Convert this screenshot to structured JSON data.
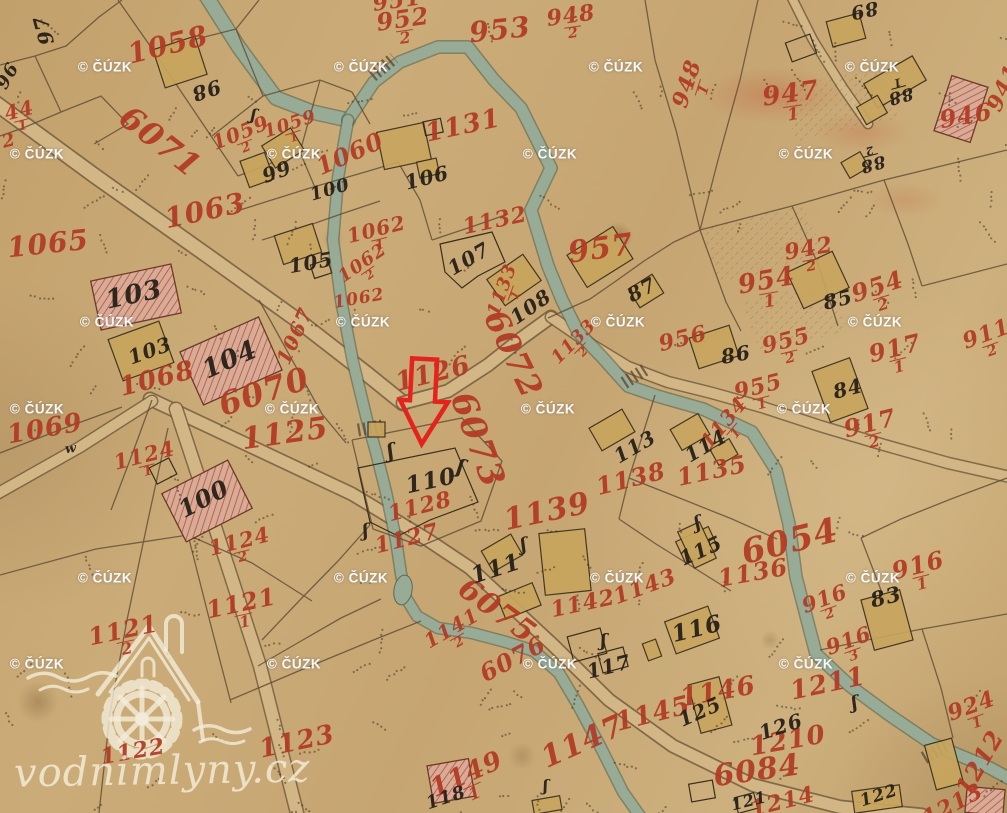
{
  "map_title": "historical cadastral map sheet",
  "watermark": {
    "text": "© ČÚZK",
    "positions": [
      {
        "x": 105,
        "y": 67
      },
      {
        "x": 361,
        "y": 67
      },
      {
        "x": 616,
        "y": 67
      },
      {
        "x": 872,
        "y": 67
      },
      {
        "x": 37,
        "y": 154
      },
      {
        "x": 294,
        "y": 154
      },
      {
        "x": 550,
        "y": 154
      },
      {
        "x": 806,
        "y": 154
      },
      {
        "x": 107,
        "y": 322
      },
      {
        "x": 363,
        "y": 322
      },
      {
        "x": 618,
        "y": 322
      },
      {
        "x": 875,
        "y": 322
      },
      {
        "x": 37,
        "y": 409
      },
      {
        "x": 292,
        "y": 409
      },
      {
        "x": 548,
        "y": 409
      },
      {
        "x": 804,
        "y": 409
      },
      {
        "x": 105,
        "y": 578
      },
      {
        "x": 361,
        "y": 578
      },
      {
        "x": 617,
        "y": 578
      },
      {
        "x": 873,
        "y": 578
      },
      {
        "x": 37,
        "y": 664
      },
      {
        "x": 294,
        "y": 664
      },
      {
        "x": 550,
        "y": 664
      },
      {
        "x": 806,
        "y": 664
      }
    ]
  },
  "logo": {
    "text": "vodnimlyny.cz",
    "icon": "watermill-house-icon"
  },
  "arrow": {
    "color": "#e4231d",
    "shape": "hollow-down-arrow",
    "points_at_parcel": "110"
  },
  "colors": {
    "paper": "#c7a673",
    "stream": "#97ab97",
    "road": "#d3b685",
    "building_wood": "#c8a55e",
    "building_stone": "#d9ab97",
    "ink_red": "#b23a24",
    "ink_black": "#272019",
    "arrow": "#e4231d",
    "watermark": "#ffffff",
    "logo": "#f2ecd8"
  },
  "labels": {
    "red": [
      {
        "t": "951",
        "x": 397,
        "y": 1,
        "r": -8,
        "s": 22
      },
      {
        "t": "1058",
        "x": 168,
        "y": 45,
        "r": -14,
        "s": 28
      },
      {
        "t": "952",
        "d": "2",
        "x": 404,
        "y": 27,
        "r": -8,
        "s": 24
      },
      {
        "t": "953",
        "x": 500,
        "y": 30,
        "r": -6,
        "s": 28
      },
      {
        "t": "948",
        "d": "2",
        "x": 572,
        "y": 23,
        "r": -8,
        "s": 22
      },
      {
        "t": "948",
        "d": "1",
        "x": 694,
        "y": 86,
        "r": -72,
        "s": 22
      },
      {
        "t": "947",
        "d": "1",
        "x": 792,
        "y": 102,
        "r": -8,
        "s": 26
      },
      {
        "t": "946",
        "x": 966,
        "y": 116,
        "r": -10,
        "s": 24
      },
      {
        "t": "941",
        "x": 1004,
        "y": 88,
        "r": -65,
        "s": 22
      },
      {
        "t": "942",
        "d": "2",
        "x": 810,
        "y": 256,
        "r": -10,
        "s": 22
      },
      {
        "t": "6071",
        "x": 160,
        "y": 142,
        "r": 38,
        "s": 32
      },
      {
        "t": "1059",
        "d": "2",
        "x": 243,
        "y": 139,
        "r": -22,
        "s": 20
      },
      {
        "t": "1059",
        "d": "1",
        "x": 292,
        "y": 130,
        "r": -18,
        "s": 18
      },
      {
        "t": "1060",
        "x": 350,
        "y": 154,
        "r": -24,
        "s": 24
      },
      {
        "t": "1131",
        "x": 463,
        "y": 126,
        "r": -12,
        "s": 26
      },
      {
        "t": "1063",
        "x": 205,
        "y": 211,
        "r": -12,
        "s": 28
      },
      {
        "t": "1065",
        "x": 48,
        "y": 244,
        "r": -6,
        "s": 28
      },
      {
        "t": "1062",
        "d": "1",
        "x": 378,
        "y": 236,
        "r": -14,
        "s": 20
      },
      {
        "t": "1062",
        "d": "2",
        "x": 366,
        "y": 268,
        "r": -35,
        "s": 18
      },
      {
        "t": "1062",
        "x": 359,
        "y": 299,
        "r": -10,
        "s": 17
      },
      {
        "t": "1132",
        "x": 495,
        "y": 221,
        "r": -12,
        "s": 22
      },
      {
        "t": "957",
        "x": 601,
        "y": 249,
        "r": -8,
        "s": 30
      },
      {
        "t": "1067",
        "x": 295,
        "y": 336,
        "r": -66,
        "s": 20
      },
      {
        "t": "1068",
        "x": 157,
        "y": 379,
        "r": -14,
        "s": 26
      },
      {
        "t": "6070",
        "x": 264,
        "y": 392,
        "r": -18,
        "s": 32
      },
      {
        "t": "1069",
        "x": 45,
        "y": 429,
        "r": -10,
        "s": 26
      },
      {
        "t": "1125",
        "x": 285,
        "y": 434,
        "r": -8,
        "s": 30
      },
      {
        "t": "1124",
        "d": "1",
        "x": 146,
        "y": 462,
        "r": -14,
        "s": 21
      },
      {
        "t": "1124",
        "d": "2",
        "x": 241,
        "y": 548,
        "r": -14,
        "s": 21
      },
      {
        "t": "1126",
        "x": 433,
        "y": 374,
        "r": -14,
        "s": 26
      },
      {
        "t": "6072",
        "x": 513,
        "y": 354,
        "r": 64,
        "s": 32
      },
      {
        "t": "1133",
        "d": "1",
        "x": 508,
        "y": 292,
        "r": -70,
        "s": 18
      },
      {
        "t": "1133",
        "d": "2",
        "x": 578,
        "y": 346,
        "r": -45,
        "s": 18
      },
      {
        "t": "6073",
        "x": 477,
        "y": 440,
        "r": 70,
        "s": 34
      },
      {
        "t": "1128",
        "x": 420,
        "y": 507,
        "r": -14,
        "s": 22
      },
      {
        "t": "1127",
        "x": 407,
        "y": 539,
        "r": -14,
        "s": 22
      },
      {
        "t": "1139",
        "x": 547,
        "y": 512,
        "r": -12,
        "s": 30
      },
      {
        "t": "1138",
        "x": 631,
        "y": 479,
        "r": -14,
        "s": 24
      },
      {
        "t": "1134",
        "d": "1",
        "x": 729,
        "y": 427,
        "r": -50,
        "s": 20
      },
      {
        "t": "1135",
        "x": 712,
        "y": 471,
        "r": -12,
        "s": 24
      },
      {
        "t": "956",
        "x": 683,
        "y": 339,
        "r": -14,
        "s": 22
      },
      {
        "t": "955",
        "d": "2",
        "x": 788,
        "y": 348,
        "r": -14,
        "s": 22
      },
      {
        "t": "955",
        "d": "1",
        "x": 760,
        "y": 394,
        "r": -14,
        "s": 22
      },
      {
        "t": "954",
        "d": "1",
        "x": 768,
        "y": 289,
        "r": -10,
        "s": 26
      },
      {
        "t": "954",
        "d": "2",
        "x": 880,
        "y": 294,
        "r": -18,
        "s": 24
      },
      {
        "t": "917",
        "d": "1",
        "x": 897,
        "y": 356,
        "r": -14,
        "s": 24
      },
      {
        "t": "911",
        "d": "2",
        "x": 989,
        "y": 341,
        "r": -20,
        "s": 22
      },
      {
        "t": "917",
        "d": "2",
        "x": 872,
        "y": 431,
        "r": -14,
        "s": 24
      },
      {
        "t": "1136",
        "x": 753,
        "y": 573,
        "r": -10,
        "s": 24
      },
      {
        "t": "6054",
        "x": 790,
        "y": 542,
        "r": -14,
        "s": 34
      },
      {
        "t": "1141",
        "d": "2",
        "x": 455,
        "y": 634,
        "r": -30,
        "s": 20
      },
      {
        "t": "1142",
        "x": 583,
        "y": 604,
        "r": -12,
        "s": 22
      },
      {
        "t": "1143",
        "x": 645,
        "y": 587,
        "r": -20,
        "s": 22
      },
      {
        "t": "6075",
        "x": 497,
        "y": 611,
        "r": 36,
        "s": 30
      },
      {
        "t": "6076",
        "x": 513,
        "y": 659,
        "r": -28,
        "s": 24
      },
      {
        "t": "1145",
        "x": 653,
        "y": 714,
        "r": -14,
        "s": 26
      },
      {
        "t": "1146",
        "x": 718,
        "y": 692,
        "r": -10,
        "s": 26
      },
      {
        "t": "1147",
        "x": 583,
        "y": 742,
        "r": -24,
        "s": 30
      },
      {
        "t": "1149",
        "d": "1",
        "x": 470,
        "y": 782,
        "r": -24,
        "s": 26
      },
      {
        "t": "1123",
        "x": 297,
        "y": 742,
        "r": -12,
        "s": 26
      },
      {
        "t": "1121",
        "d": "1",
        "x": 243,
        "y": 611,
        "r": -12,
        "s": 24
      },
      {
        "t": "1121",
        "d": "2",
        "x": 125,
        "y": 638,
        "r": -12,
        "s": 24
      },
      {
        "t": "1122",
        "x": 133,
        "y": 752,
        "r": -10,
        "s": 22
      },
      {
        "t": "916",
        "d": "1",
        "x": 920,
        "y": 573,
        "r": -14,
        "s": 24
      },
      {
        "t": "916",
        "d": "2",
        "x": 827,
        "y": 605,
        "r": -20,
        "s": 21
      },
      {
        "t": "916",
        "d": "3",
        "x": 851,
        "y": 647,
        "r": -20,
        "s": 21
      },
      {
        "t": "924",
        "d": "1",
        "x": 974,
        "y": 713,
        "r": -20,
        "s": 22
      },
      {
        "t": "1210",
        "x": 788,
        "y": 741,
        "r": -10,
        "s": 26
      },
      {
        "t": "1211",
        "x": 828,
        "y": 684,
        "r": -12,
        "s": 26
      },
      {
        "t": "1212",
        "x": 980,
        "y": 763,
        "r": -60,
        "s": 24
      },
      {
        "t": "1213",
        "x": 953,
        "y": 805,
        "r": -28,
        "s": 22
      },
      {
        "t": "1214",
        "x": 783,
        "y": 802,
        "r": -14,
        "s": 22
      },
      {
        "t": "6084",
        "x": 757,
        "y": 771,
        "r": -8,
        "s": 30
      },
      {
        "t": "44",
        "d": "1",
        "x": 21,
        "y": 117,
        "r": -14,
        "s": 20
      },
      {
        "t": "2",
        "x": 9,
        "y": 141,
        "r": -14,
        "s": 18
      }
    ],
    "black": [
      {
        "t": "97",
        "x": 44,
        "y": 30,
        "r": -105,
        "s": 20
      },
      {
        "t": "96",
        "x": 8,
        "y": 76,
        "r": -60,
        "s": 18
      },
      {
        "t": "98",
        "x": 206,
        "y": 90,
        "r": 162,
        "s": 20
      },
      {
        "t": "99",
        "x": 277,
        "y": 172,
        "r": -20,
        "s": 20
      },
      {
        "t": "100",
        "x": 330,
        "y": 190,
        "r": -16,
        "s": 18
      },
      {
        "t": "106",
        "x": 427,
        "y": 178,
        "r": -14,
        "s": 20
      },
      {
        "t": "105",
        "x": 311,
        "y": 263,
        "r": -10,
        "s": 20
      },
      {
        "t": "107",
        "x": 469,
        "y": 259,
        "r": -30,
        "s": 20
      },
      {
        "t": "108",
        "x": 531,
        "y": 307,
        "r": -35,
        "s": 20
      },
      {
        "t": "87",
        "x": 642,
        "y": 290,
        "r": -28,
        "s": 20
      },
      {
        "t": "89",
        "x": 864,
        "y": 10,
        "r": 168,
        "s": 19
      },
      {
        "t": "88",
        "d": "1",
        "x": 899,
        "y": 90,
        "r": 165,
        "s": 17
      },
      {
        "t": "88",
        "d": "2",
        "x": 871,
        "y": 158,
        "r": 165,
        "s": 17
      },
      {
        "t": "85",
        "x": 838,
        "y": 300,
        "r": -14,
        "s": 20
      },
      {
        "t": "86",
        "x": 736,
        "y": 355,
        "r": -10,
        "s": 20
      },
      {
        "t": "84",
        "x": 848,
        "y": 389,
        "r": -14,
        "s": 20
      },
      {
        "t": "103",
        "x": 134,
        "y": 295,
        "r": -12,
        "s": 26
      },
      {
        "t": "103",
        "x": 150,
        "y": 351,
        "r": -20,
        "s": 20
      },
      {
        "t": "104",
        "x": 230,
        "y": 360,
        "r": -24,
        "s": 26
      },
      {
        "t": "100",
        "x": 204,
        "y": 499,
        "r": -28,
        "s": 24
      },
      {
        "t": "110",
        "x": 431,
        "y": 481,
        "r": -12,
        "s": 23
      },
      {
        "t": "113",
        "x": 635,
        "y": 447,
        "r": -30,
        "s": 20
      },
      {
        "t": "114",
        "x": 706,
        "y": 446,
        "r": -30,
        "s": 20
      },
      {
        "t": "115",
        "x": 701,
        "y": 551,
        "r": -24,
        "s": 20
      },
      {
        "t": "111",
        "x": 496,
        "y": 569,
        "r": -18,
        "s": 23
      },
      {
        "t": "116",
        "x": 697,
        "y": 629,
        "r": -14,
        "s": 23
      },
      {
        "t": "117",
        "x": 609,
        "y": 667,
        "r": -14,
        "s": 20
      },
      {
        "t": "118",
        "x": 446,
        "y": 798,
        "r": -18,
        "s": 18
      },
      {
        "t": "125",
        "x": 700,
        "y": 712,
        "r": -24,
        "s": 20
      },
      {
        "t": "126",
        "x": 781,
        "y": 727,
        "r": -18,
        "s": 20
      },
      {
        "t": "83",
        "x": 886,
        "y": 597,
        "r": -14,
        "s": 21
      },
      {
        "t": "122",
        "x": 879,
        "y": 796,
        "r": -18,
        "s": 17
      },
      {
        "t": "121",
        "x": 749,
        "y": 801,
        "r": -14,
        "s": 16
      },
      {
        "t": "w",
        "x": 71,
        "y": 449,
        "r": -8,
        "s": 13
      },
      {
        "t": "ʃ",
        "x": 391,
        "y": 451,
        "r": -10,
        "s": 20
      },
      {
        "t": "ʃ",
        "x": 461,
        "y": 467,
        "r": 15,
        "s": 20
      },
      {
        "t": "ʃ",
        "x": 366,
        "y": 531,
        "r": -5,
        "s": 18
      },
      {
        "t": "ʃ",
        "x": 524,
        "y": 545,
        "r": -10,
        "s": 18
      },
      {
        "t": "ʃ",
        "x": 604,
        "y": 641,
        "r": 0,
        "s": 18
      },
      {
        "t": "ʃ",
        "x": 855,
        "y": 703,
        "r": -10,
        "s": 18
      },
      {
        "t": "ʃ",
        "x": 698,
        "y": 523,
        "r": -15,
        "s": 18
      },
      {
        "t": "ʃ",
        "x": 254,
        "y": 115,
        "r": 10,
        "s": 16
      },
      {
        "t": "ʃ",
        "x": 546,
        "y": 786,
        "r": 0,
        "s": 16
      }
    ]
  }
}
